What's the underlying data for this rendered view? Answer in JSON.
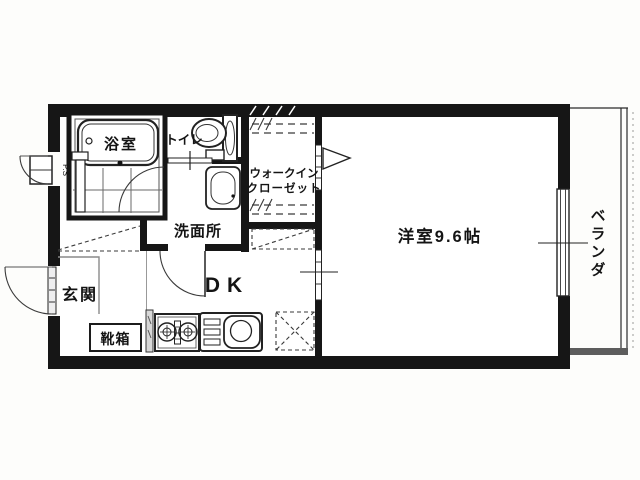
{
  "floorplan": {
    "labels": {
      "bathroom": "浴室",
      "toilet": "トイレ",
      "walkin_closet_line1": "ウォークイン",
      "walkin_closet_line2": "クローゼット",
      "washroom": "洗面所",
      "entrance": "玄関",
      "shoe_cabinet": "靴箱",
      "dining_kitchen": "DK",
      "western_room": "洋室9.6帖",
      "pipe_space": "P.S",
      "veranda_chars": [
        "ベ",
        "ラ",
        "ン",
        "ダ"
      ]
    },
    "colors": {
      "wall": "#161616",
      "line": "#2b2b2b",
      "background": "#fdfdfb",
      "paper": "#ffffff"
    }
  }
}
